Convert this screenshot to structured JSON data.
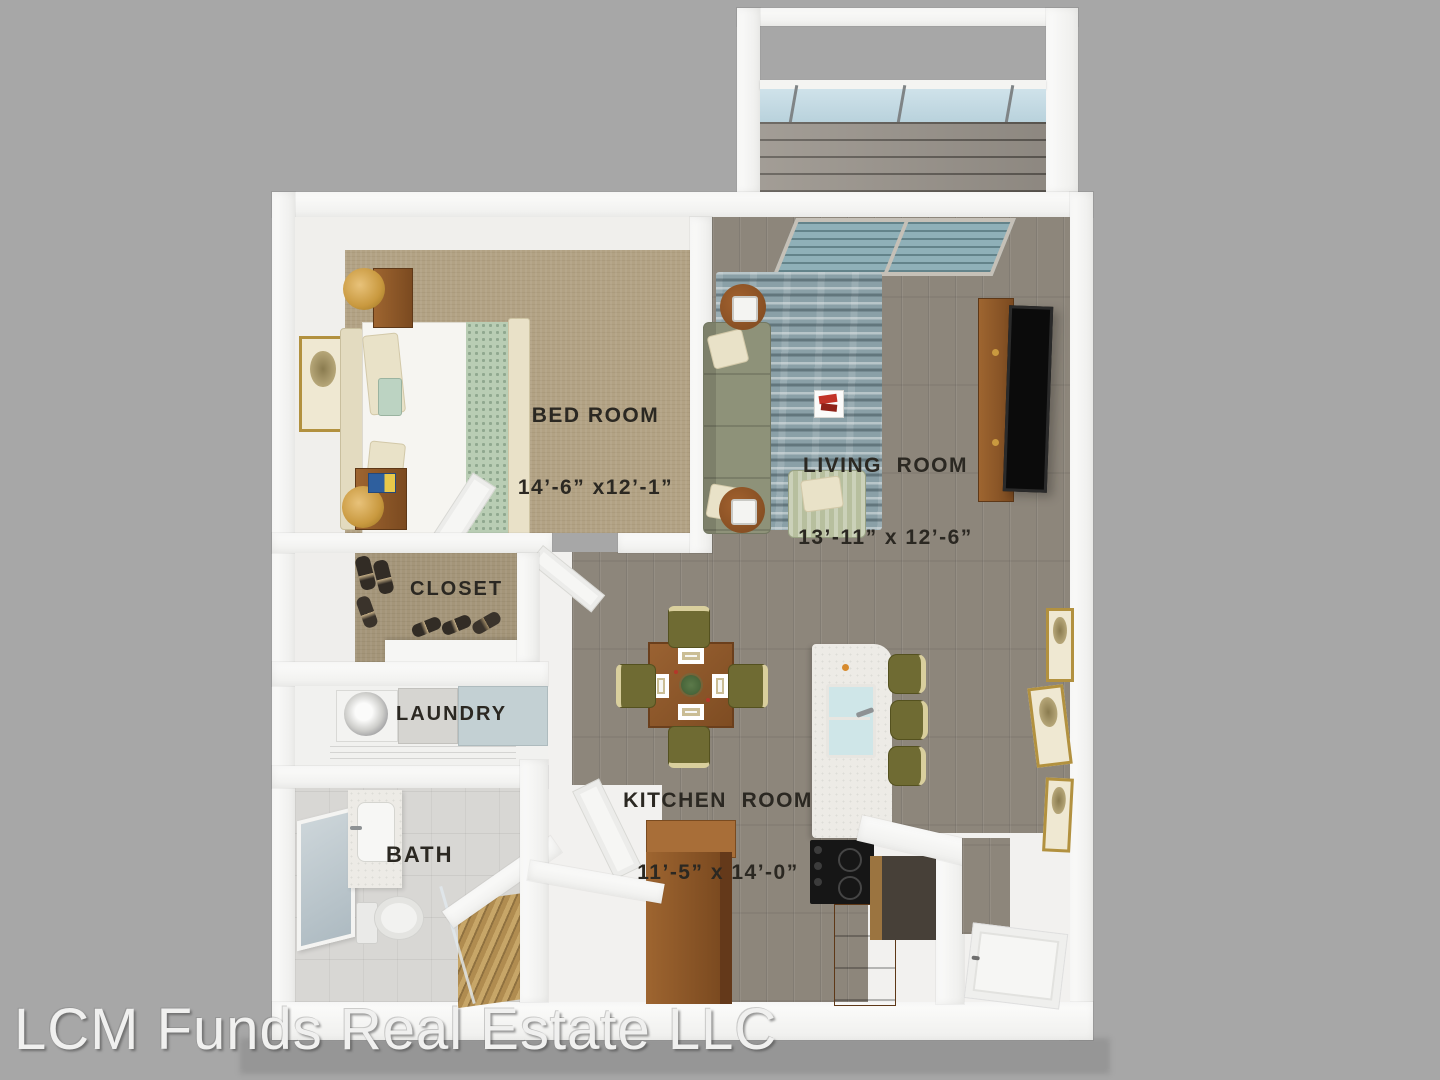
{
  "watermark": "LCM Funds Real Estate LLC",
  "rooms": {
    "bedroom": {
      "name": "BED ROOM",
      "dims": "14’-6” x12’-1”"
    },
    "living": {
      "name": "LIVING  ROOM",
      "dims": "13’-11” x 12’-6”"
    },
    "kitchen": {
      "name": "KITCHEN  ROOM",
      "dims": "11’-5” x 14’-0”"
    },
    "closet": {
      "name": "CLOSET"
    },
    "laundry": {
      "name": "LAUNDRY"
    },
    "bath": {
      "name": "BATH"
    }
  },
  "colors": {
    "background": "#a7a7a7",
    "wall_white": "#f7f7f5",
    "wood_floor_gray": "#8d867b",
    "bedroom_carpet": "#b2a284",
    "bath_tile": "#d8d7d4",
    "balcony_deck": "#98928a",
    "glass_blue": "#cfe2ea",
    "rug_teal": "#8aa0a7",
    "sofa_sage": "#8e9279",
    "armchair_sage": "#b7bf9e",
    "chair_olive": "#6f6b33",
    "furniture_wood": "#8a5428",
    "island_marble": "#edebe6",
    "cooktop_black": "#161616",
    "frame_gold": "#b2913f",
    "label_text": "#2b2822",
    "watermark_text": "#f0f0ef"
  }
}
